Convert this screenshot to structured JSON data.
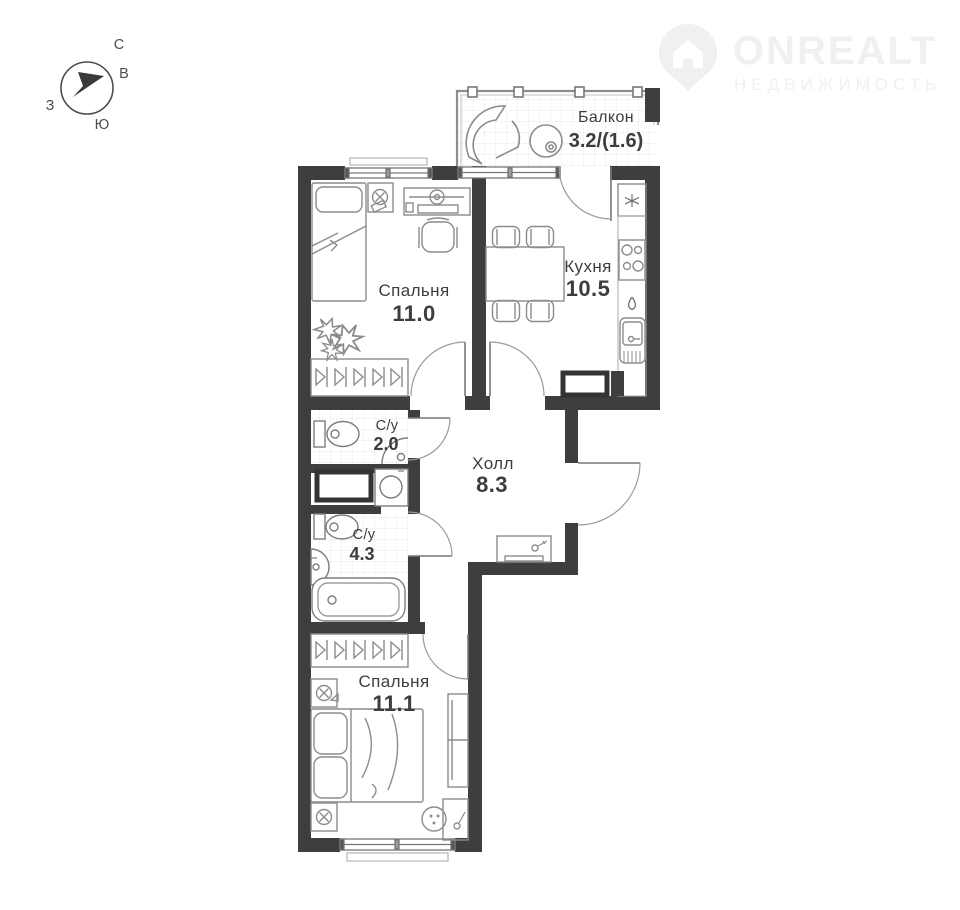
{
  "compass": {
    "north": "С",
    "east": "В",
    "west": "З",
    "south": "Ю"
  },
  "watermark": {
    "brand": "ONREALT",
    "tagline": "НЕДВИЖИМОСТЬ"
  },
  "rooms": [
    {
      "id": "balcony",
      "name": "Балкон",
      "area": "3.2/(1.6)"
    },
    {
      "id": "bedroom-1",
      "name": "Спальня",
      "area": "11.0"
    },
    {
      "id": "kitchen",
      "name": "Кухня",
      "area": "10.5"
    },
    {
      "id": "wc-small",
      "name": "С/у",
      "area": "2.0"
    },
    {
      "id": "hall",
      "name": "Холл",
      "area": "8.3"
    },
    {
      "id": "wc-large",
      "name": "С/у",
      "area": "4.3"
    },
    {
      "id": "bedroom-2",
      "name": "Спальня",
      "area": "11.1"
    }
  ],
  "colors": {
    "wall": "#3e3e3e",
    "furniture": "#8c8c8c",
    "sanitary": "#7d7d7d",
    "tile": "#e9e9e9",
    "label": "#3d3d3d",
    "door": "#9a9a9a",
    "watermark": "#f0f0f0"
  }
}
